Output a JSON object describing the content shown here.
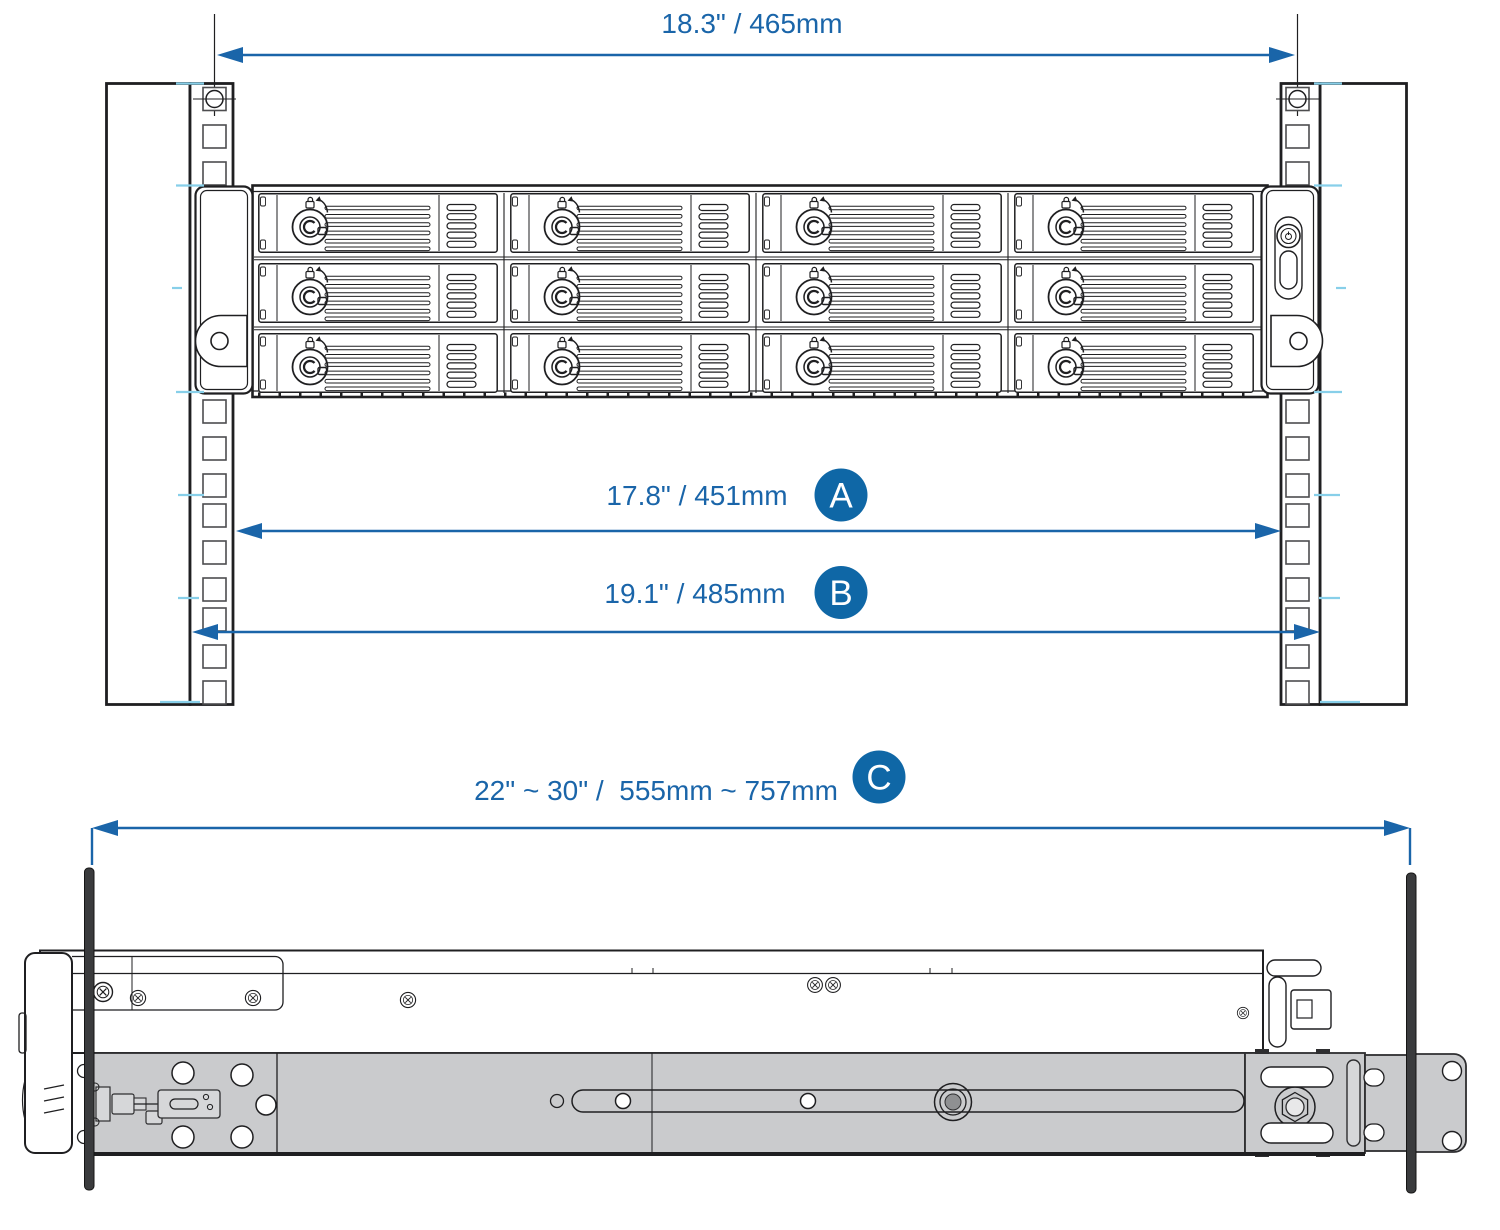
{
  "figure": {
    "dims": {
      "top": {
        "label": "18.3\" / 465mm"
      },
      "a": {
        "label": "17.8\" / 451mm",
        "badge": "A"
      },
      "b": {
        "label": "19.1\" / 485mm",
        "badge": "B"
      },
      "c": {
        "label": "22\" ~ 30\" /  555mm ~ 757mm",
        "badge": "C"
      }
    },
    "colors": {
      "dimension_blue": "#1a65a9",
      "badge_blue": "#0f67a6",
      "line_black": "#1f1f21",
      "rail_gray": "#cacbcd",
      "tick_cyan": "#87cfe9",
      "post_dark": "#3a3b3d"
    }
  }
}
